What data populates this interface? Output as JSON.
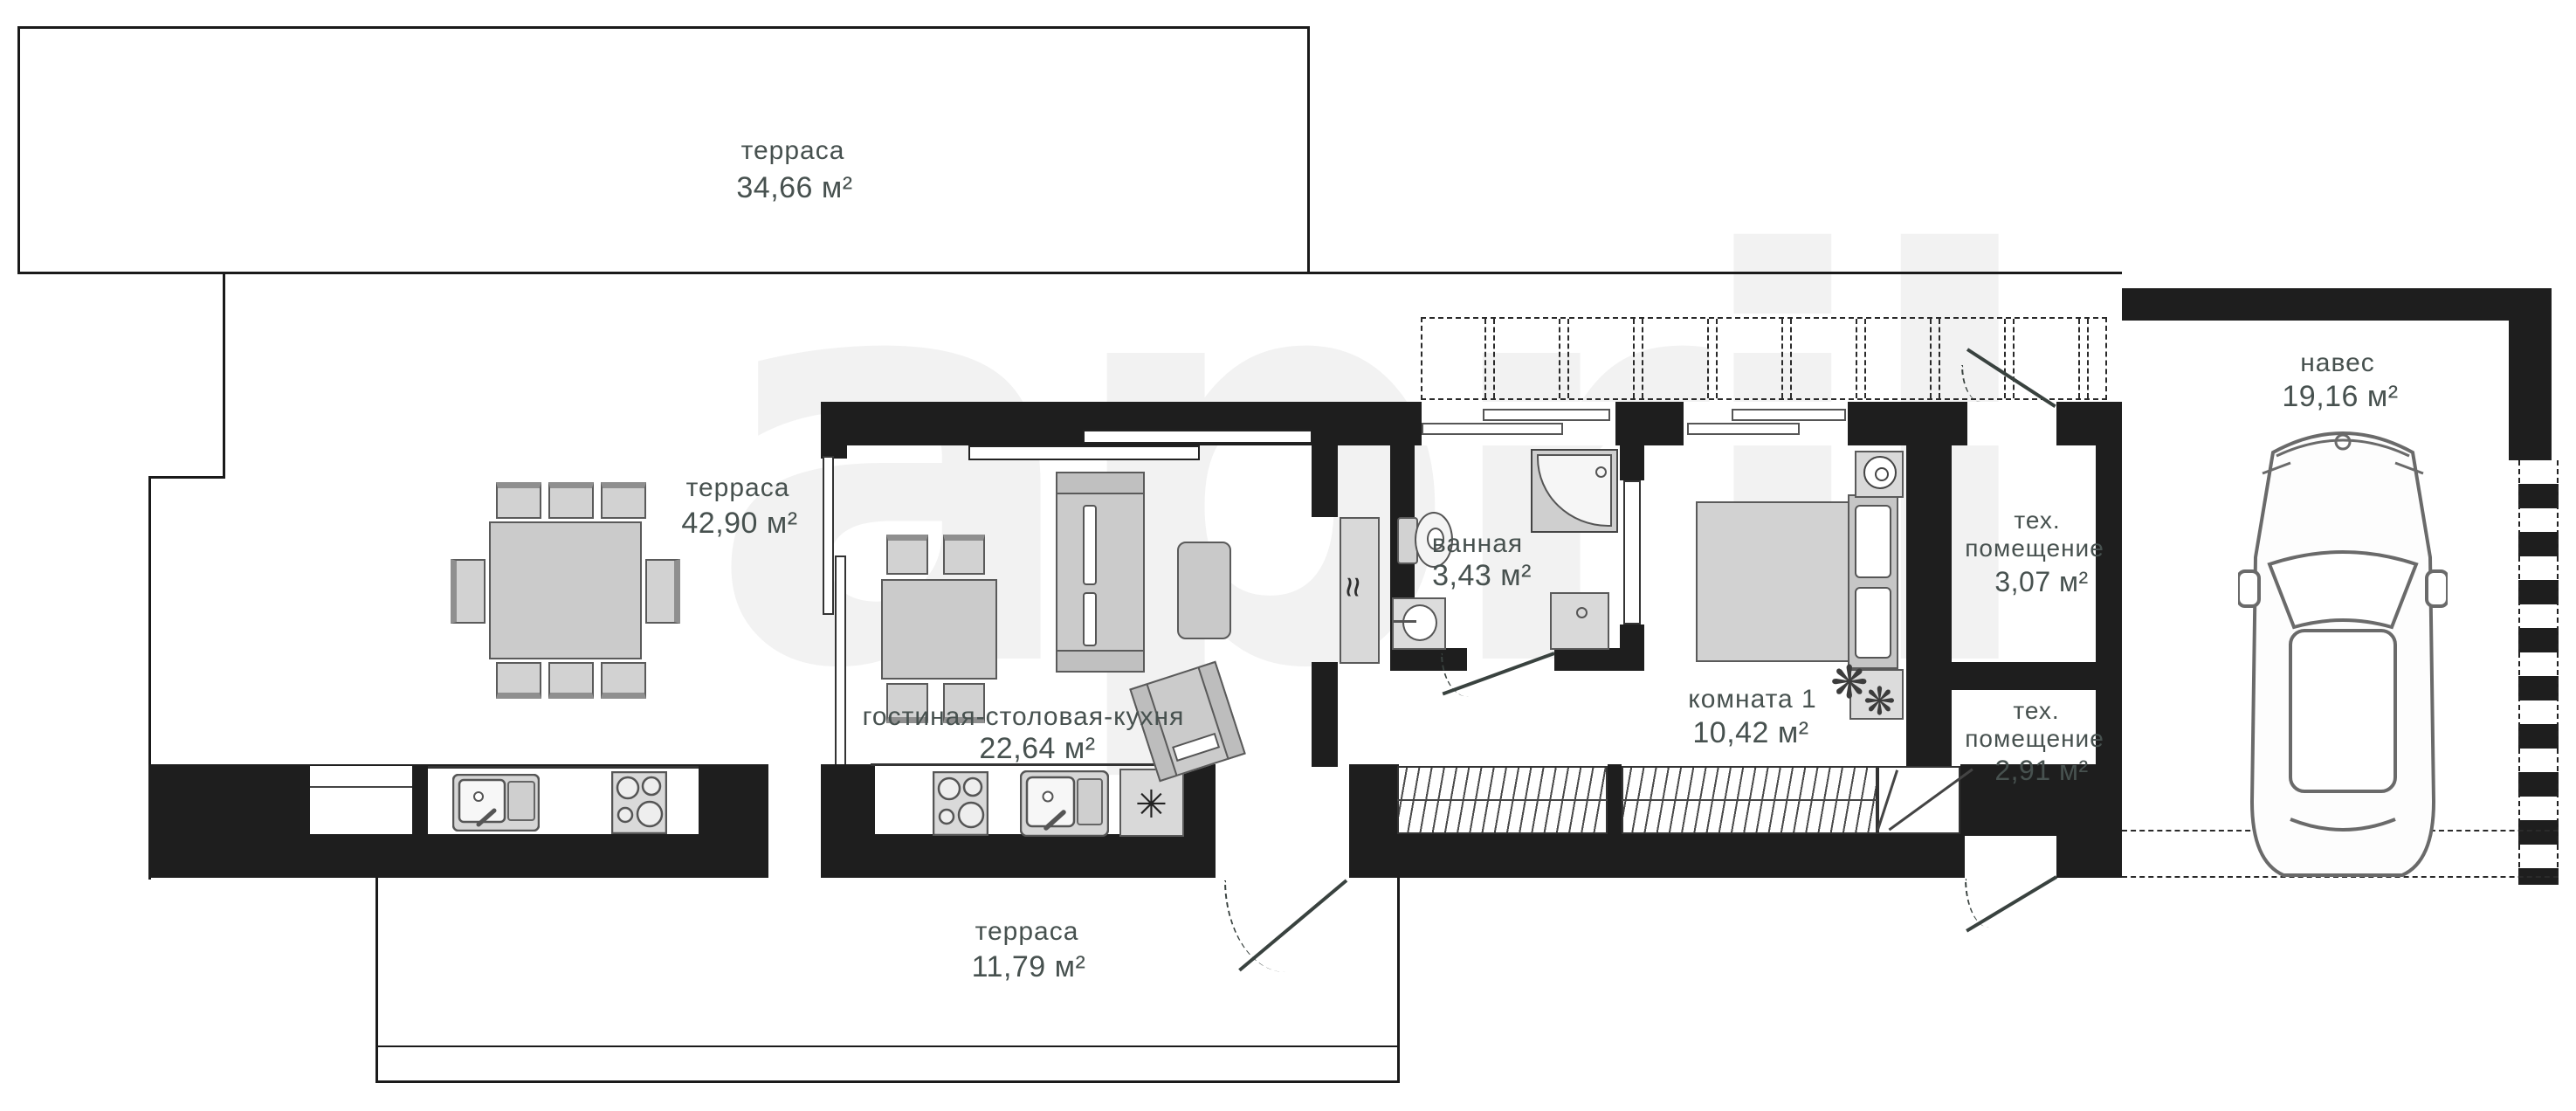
{
  "plan": {
    "watermark_text": "april",
    "colors": {
      "wall": "#1e1e1e",
      "line": "#1a1a1a",
      "text": "#47514f",
      "furniture_fill": "#d2d2d2",
      "furniture_stroke": "#5a5a5a"
    },
    "rooms": {
      "terrace_top": {
        "name": "терраса",
        "area": "34,66 м²"
      },
      "terrace_left": {
        "name": "терраса",
        "area": "42,90 м²"
      },
      "living": {
        "name": "гостиная-столовая-кухня",
        "area": "22,64 м²"
      },
      "bathroom": {
        "name": "ванная",
        "area": "3,43 м²"
      },
      "room1": {
        "name": "комната 1",
        "area": "10,42 м²"
      },
      "tech1": {
        "name_line1": "тех.",
        "name_line2": "помещение",
        "area": "3,07 м²"
      },
      "tech2": {
        "name_line1": "тех.",
        "name_line2": "помещение",
        "area": "2,91 м²"
      },
      "canopy": {
        "name": "навес",
        "area": "19,16 м²"
      },
      "terrace_bottom": {
        "name": "терраса",
        "area": "11,79 м²"
      }
    },
    "icons": {
      "fridge_glyph": "✳",
      "boiler_glyph": "≈",
      "plant_glyph": "❋"
    }
  }
}
